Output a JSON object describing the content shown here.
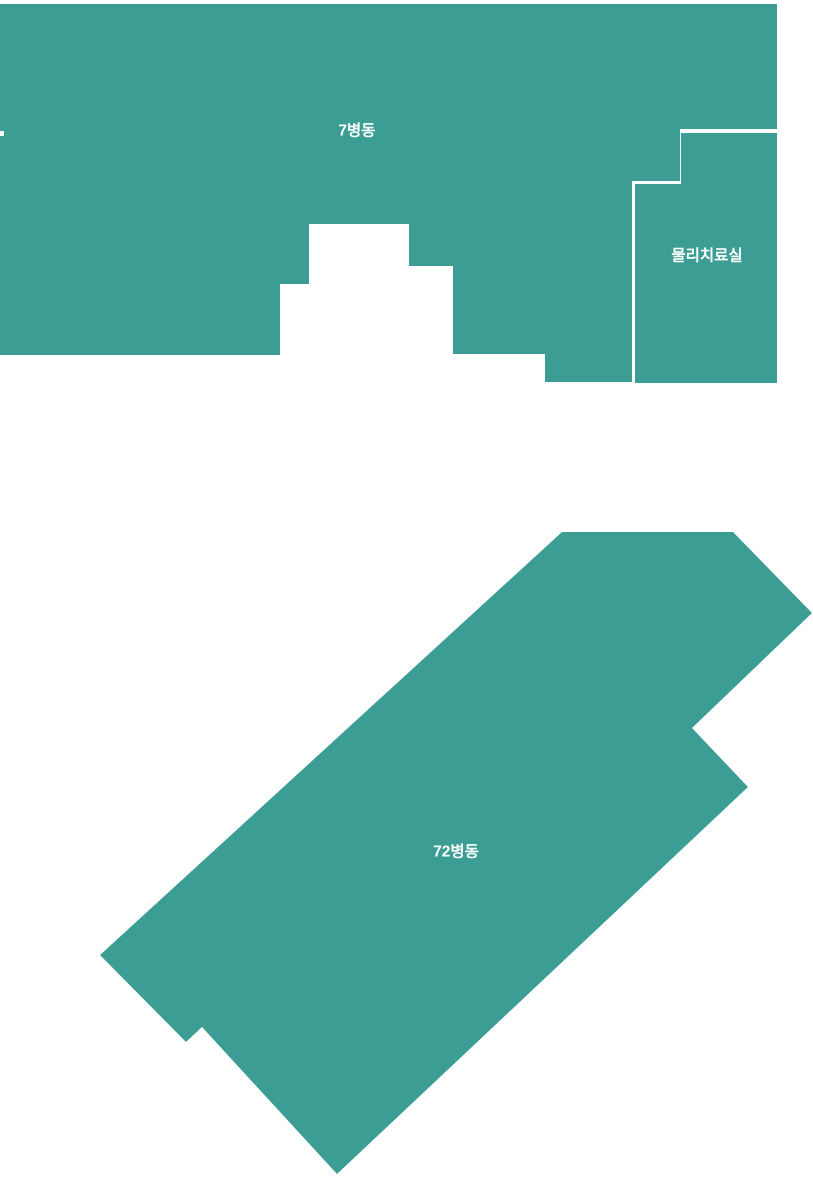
{
  "canvas": {
    "width": 813,
    "height": 1177,
    "background_color": "#FFFFFF"
  },
  "map": {
    "fill_color": "#3B9D94",
    "label_color": "#FFFFFF",
    "divider_color": "#FFFFFF",
    "areas": [
      {
        "id": "ward-7",
        "label": "7병동",
        "label_x": 357,
        "label_y": 131,
        "points": "0,4 777,4 777,129 680,129 680,181 632,181 632,382 545,382 545,354 453,354 453,266 409,266 409,224 309,224 309,284 280,284 280,355 0,355 0,136 4,136 4,131 0,131"
      },
      {
        "id": "physical-therapy-room",
        "label": "물리치료실",
        "label_x": 707,
        "label_y": 256,
        "points": "681,133 777,133 777,383 635,383 635,184 681,184"
      },
      {
        "id": "ward-72",
        "label": "72병동",
        "label_x": 456,
        "label_y": 852,
        "points": "562,532 733,532 812,613 692,728 748,787 337,1174 202,1027 186,1042 100,955"
      }
    ]
  }
}
